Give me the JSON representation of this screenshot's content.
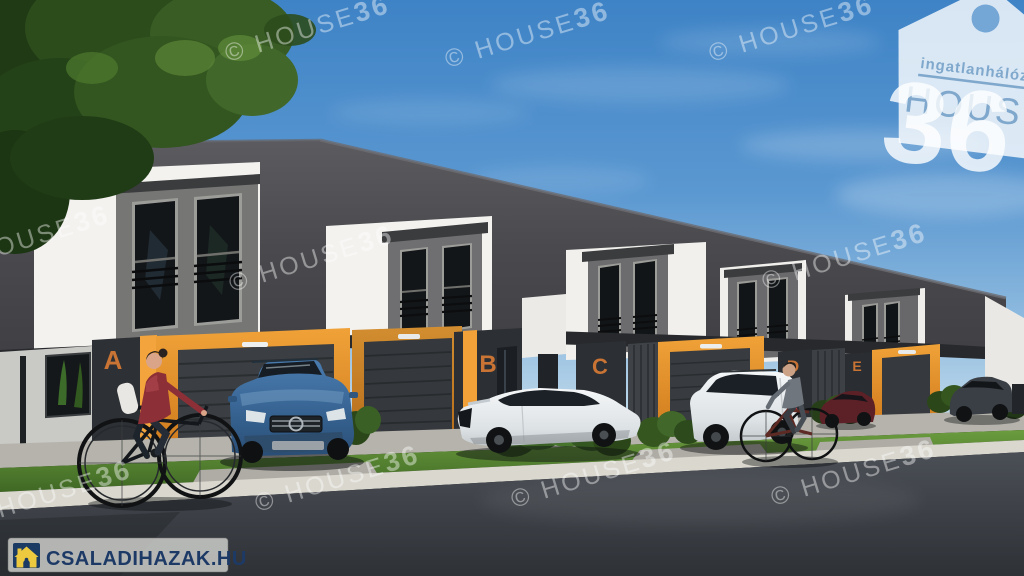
{
  "watermark": {
    "prefix": "© HOUSE",
    "number": "36"
  },
  "logo_house36": {
    "network": "ingatlanhálózat",
    "brand": "HOUSE",
    "number": "36"
  },
  "logo_csaladihazak": {
    "text": "CSALADIHAZAK.HU",
    "icon": "house-icon"
  },
  "units": [
    {
      "label": "A"
    },
    {
      "label": "B"
    },
    {
      "label": "C"
    },
    {
      "label": "D"
    },
    {
      "label": "E"
    }
  ],
  "colors": {
    "sky_top": "#3e83c6",
    "roof_gray": "#4e4e52",
    "facade_white": "#f3f2ef",
    "dormer_gray": "#767674",
    "accent_orange": "#e6932b",
    "unit_letter_orange": "#c97434",
    "watermark_white": "#ffffff",
    "csaladihazak_navy": "#1d3a66",
    "csaladihazak_yellow": "#ecc93f",
    "car_blue": "#3d6fa3",
    "road_gray": "#3c4046",
    "grass_green": "#4e7c2e"
  }
}
